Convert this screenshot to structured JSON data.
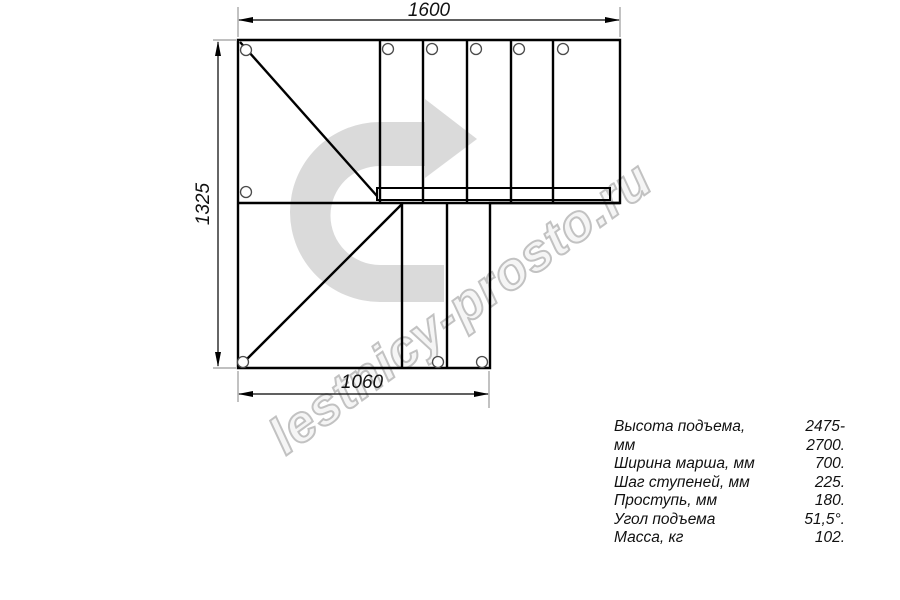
{
  "watermark": {
    "text": "lestnicy-prosto.ru",
    "arrow_icon": "u-turn-right-arrow",
    "arrow_color": "#dadada",
    "text_outline_color": "#c2c2c2"
  },
  "drawing": {
    "type": "staircase-plan-top-view",
    "line_color": "#000000",
    "extension_line_color": "#9a9a9a",
    "dimensions": {
      "top_width_mm": "1600",
      "left_height_mm": "1325",
      "bottom_width_mm": "1060"
    }
  },
  "specs": {
    "rows": [
      {
        "label": "Высота подъема, мм",
        "value": "2475-2700."
      },
      {
        "label": "Ширина марша, мм",
        "value": "700."
      },
      {
        "label": "Шаг ступеней, мм",
        "value": "225."
      },
      {
        "label": "Проступь, мм",
        "value": "180."
      },
      {
        "label": "Угол подъема",
        "value": "51,5°."
      },
      {
        "label": "Масса, кг",
        "value": "102."
      }
    ]
  }
}
